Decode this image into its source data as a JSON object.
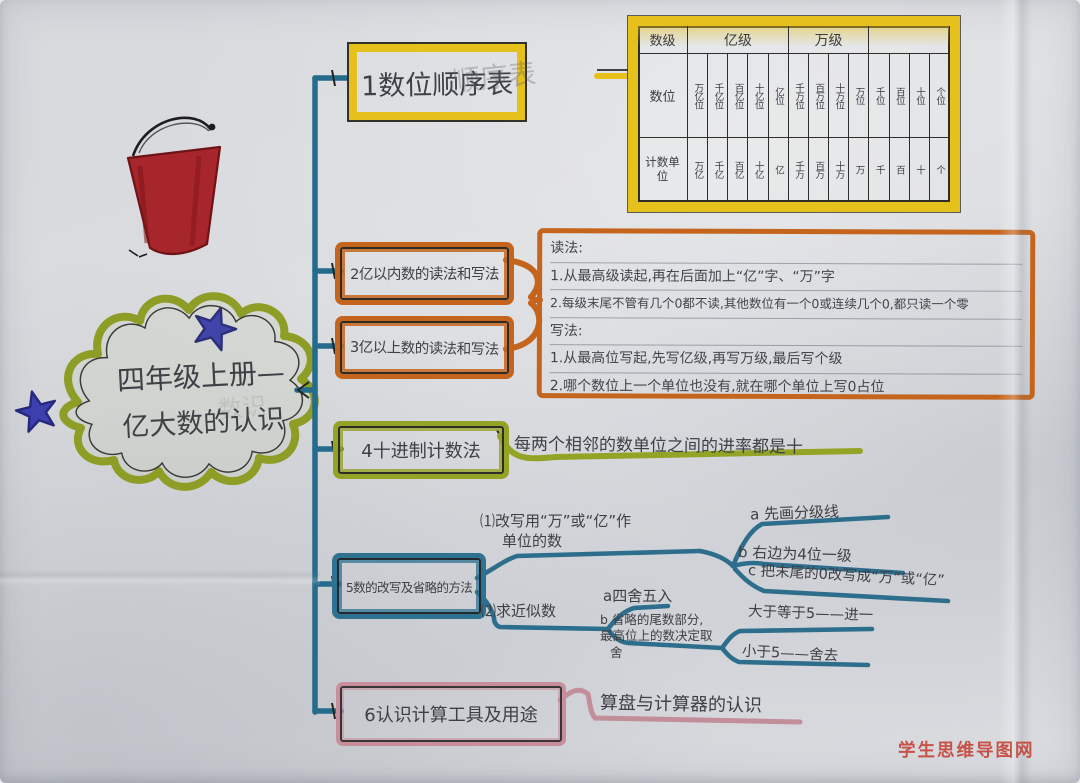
{
  "colors": {
    "trunk_blue": "#256b8c",
    "marker_yellow": "#e6c01b",
    "marker_orange": "#c5651d",
    "marker_green": "#93a325",
    "marker_blue": "#2e7191",
    "marker_pink": "#c78f9b",
    "bucket_red": "#a6262c",
    "star_blue": "#3d3fae",
    "watermark_red": "#c43b2e",
    "pencil": "#3e4045"
  },
  "watermark": "学生思维导图网",
  "center_topic": {
    "line1": "四年级上册—",
    "line2": "亿大数的认识",
    "ghost": "数识"
  },
  "branch1": {
    "label": "1数位顺序表",
    "ghost": "顺序表"
  },
  "place_table": {
    "row_level": {
      "label": "数级",
      "yi": "亿级",
      "wan": "万级",
      "ge": ""
    },
    "row_digits": {
      "label": "数位",
      "cells": [
        "万亿位",
        "千亿位",
        "百亿位",
        "十亿位",
        "亿位",
        "千万位",
        "百万位",
        "十万位",
        "万位",
        "千位",
        "百位",
        "十位",
        "个位"
      ]
    },
    "row_units": {
      "label": "计数单位",
      "cells": [
        "万亿",
        "千亿",
        "百亿",
        "十亿",
        "亿",
        "千万",
        "百万",
        "十万",
        "万",
        "千",
        "百",
        "十",
        "个"
      ]
    }
  },
  "branch2": {
    "label": "2亿以内数的读法和写法"
  },
  "branch3": {
    "label": "3亿以上数的读法和写法"
  },
  "rw_rules": {
    "lines": [
      "读法:",
      "1.从最高级读起,再在后面加上“亿”字、“万”字",
      "2.每级末尾不管有几个0都不读,其他数位有一个0或连续几个0,都只读一个零",
      "写法:",
      "1.从最高位写起,先写亿级,再写万级,最后写个级",
      "2.哪个数位上一个单位也没有,就在哪个单位上写0占位"
    ]
  },
  "branch4": {
    "label": "4十进制计数法",
    "note": "每两个相邻的数单位之间的进率都是十"
  },
  "branch5": {
    "label": "5数的改写及省略的方法",
    "rewrite": {
      "line1": "⑴改写用“万”或“亿”作",
      "line2": "单位的数",
      "a": "a 先画分级线",
      "b": "b 右边为4位一级",
      "c": "c 把末尾的0改写成“万”或“亿”"
    },
    "approx": {
      "label": "⑵求近似数",
      "a": "a四舍五入",
      "b1": "b 省略的尾数部分,",
      "b2": "最高位上的数决定取",
      "b3": "舍",
      "rule_ge": "大于等于5——进一",
      "rule_lt": "小于5——舍去"
    }
  },
  "branch6": {
    "label": "6认识计算工具及用途",
    "note": "算盘与计算器的认识"
  }
}
